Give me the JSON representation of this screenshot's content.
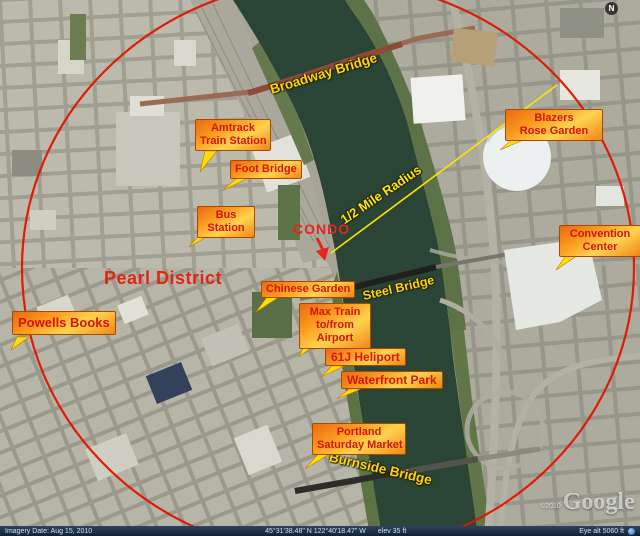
{
  "map": {
    "area_labels": {
      "pearl_district": "Pearl District",
      "condo": "CONDO",
      "radius": "1/2 Mile Radius"
    },
    "bridges": {
      "broadway": "Broadway Bridge",
      "steel": "Steel Bridge",
      "burnside": "Burnside Bridge"
    },
    "callouts": [
      {
        "id": "amtrack-train-station",
        "lines": [
          "Amtrack",
          "Train Station"
        ]
      },
      {
        "id": "foot-bridge",
        "lines": [
          "Foot Bridge"
        ]
      },
      {
        "id": "bus-station",
        "lines": [
          "Bus",
          "Station"
        ]
      },
      {
        "id": "blazers-rose-garden",
        "lines": [
          "Blazers",
          "Rose Garden"
        ]
      },
      {
        "id": "convention-center",
        "lines": [
          "Convention",
          "Center"
        ]
      },
      {
        "id": "chinese-garden",
        "lines": [
          "Chinese Garden"
        ]
      },
      {
        "id": "max-train-airport",
        "lines": [
          "Max Train",
          "to/from",
          "Airport"
        ]
      },
      {
        "id": "61j-heliport",
        "lines": [
          "61J Heliport"
        ]
      },
      {
        "id": "waterfront-park",
        "lines": [
          "Waterfront Park"
        ]
      },
      {
        "id": "portland-saturday-market",
        "lines": [
          "Portland",
          "Saturday Market"
        ]
      },
      {
        "id": "powells-books",
        "lines": [
          "Powells Books"
        ]
      }
    ]
  },
  "compass": {
    "north": "N"
  },
  "watermark": {
    "copyright": "©2010",
    "logo": "Google"
  },
  "status_bar": {
    "imagery_date": "Imagery Date: Aug 15, 2010",
    "coordinates": "45°31'38.48\" N   122°40'18.47\" W",
    "elevation": "elev   35 ft",
    "eye_altitude": "Eye alt   5060 ft"
  },
  "colors": {
    "radius_circle": "#e01400",
    "radius_line": "#ffe300",
    "callout_text": "#d6150d",
    "bridge_text": "#ffd400",
    "water": "#2a4435"
  }
}
